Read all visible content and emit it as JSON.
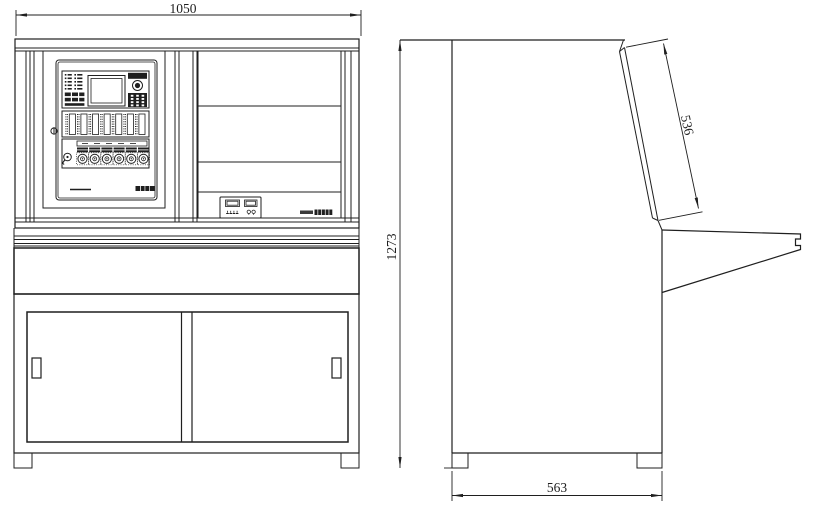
{
  "colors": {
    "background": "#ffffff",
    "line": "#1f1f1f"
  },
  "drawing": {
    "front_view": {
      "dim_width": "1050"
    },
    "side_view": {
      "dim_overall_height": "1273",
      "dim_tilt_panel_length": "536",
      "dim_base_depth": "563"
    }
  },
  "icons": {
    "door_lock": "small-circle-keyhole",
    "key_switch": "round-key-switch",
    "buzzer": "concentric-circle-speaker",
    "keypad": "dark-key-grid",
    "brand_logo": "dark-logo-mark",
    "model_label": "tiny-text-smudge",
    "door_handles": "recessed-rect-handle",
    "dimension_arrows": "cad-filled-arrowheads"
  }
}
